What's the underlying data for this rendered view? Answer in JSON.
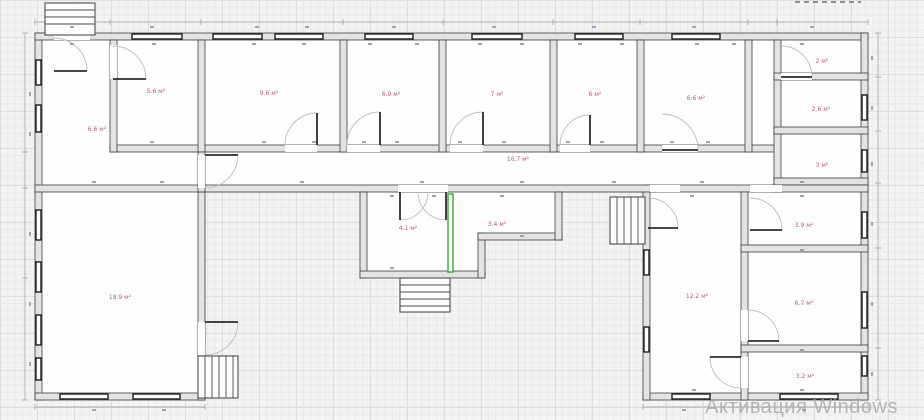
{
  "plan": {
    "unit_suffix": "м²",
    "rooms": [
      {
        "name": "hall-left",
        "area_label": "6.6 м²"
      },
      {
        "name": "room-top-1",
        "area_label": "5.6 м²"
      },
      {
        "name": "room-top-2",
        "area_label": "9.6 м²"
      },
      {
        "name": "room-top-3",
        "area_label": "6.9 м²"
      },
      {
        "name": "room-top-4",
        "area_label": "7 м²"
      },
      {
        "name": "room-top-5",
        "area_label": "6 м²"
      },
      {
        "name": "room-top-6",
        "area_label": "6.6 м²"
      },
      {
        "name": "room-wing-1",
        "area_label": "2 м²"
      },
      {
        "name": "room-wing-2",
        "area_label": "2.6 м²"
      },
      {
        "name": "room-wing-3",
        "area_label": "3 м²"
      },
      {
        "name": "corridor",
        "area_label": "16.7 м²"
      },
      {
        "name": "room-mid-1",
        "area_label": "4.1 м²"
      },
      {
        "name": "room-mid-2",
        "area_label": "3.4 м²"
      },
      {
        "name": "room-right-1",
        "area_label": "3.9 м²"
      },
      {
        "name": "room-big-left",
        "area_label": "18.9 м²"
      },
      {
        "name": "room-right-big",
        "area_label": "12.2 м²"
      },
      {
        "name": "room-right-2",
        "area_label": "6.7 м²"
      },
      {
        "name": "room-right-3",
        "area_label": "3.2 м²"
      }
    ]
  },
  "colors": {
    "area_label": "#c05a70",
    "wall_fill": "#e3e3e1",
    "wall_edge": "#3d3d3d",
    "window_edge": "#1c1c1c",
    "door_arc": "#bdbdbd",
    "highlight_wall": "#3fae3a",
    "dimension": "#9c9c9c",
    "watermark": "#a6a6a6"
  },
  "watermark": {
    "text": "Активация Windows"
  }
}
